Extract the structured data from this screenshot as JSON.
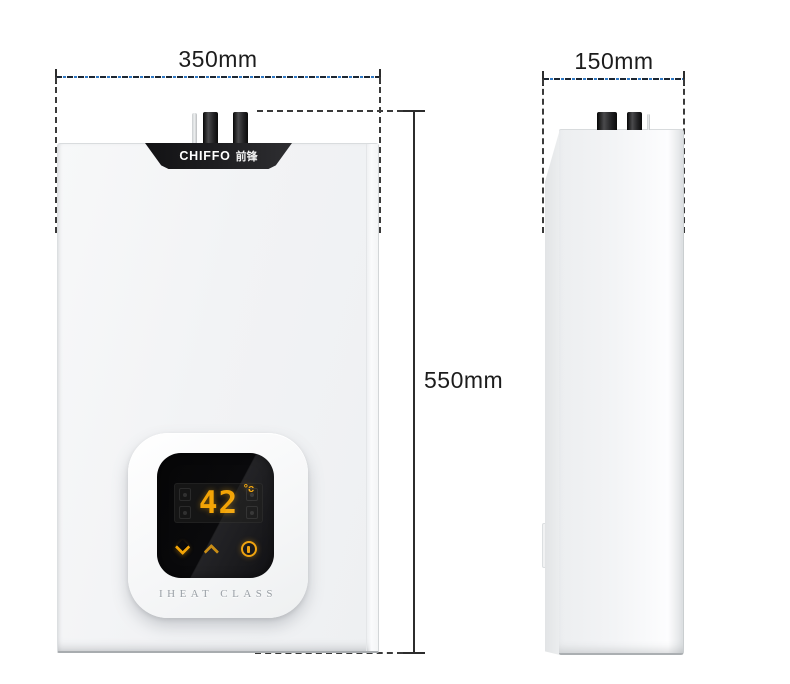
{
  "diagram": {
    "type": "product-dimensions",
    "views": [
      "front",
      "side"
    ]
  },
  "annotations": {
    "width": {
      "label": "350mm"
    },
    "depth": {
      "label": "150mm"
    },
    "height": {
      "label": "550mm"
    }
  },
  "front_view": {
    "brand": "CHIFFO",
    "brand_cn": "前锋",
    "display": {
      "temperature": "42",
      "unit": "°c"
    },
    "series_label": "IHEAT CLASS",
    "buttons": [
      "chevron-down",
      "chevron-up",
      "power"
    ]
  },
  "colors": {
    "display_accent": "#F3A406",
    "dimension_dash_blue": "#2F78C4",
    "dimension_dash_dark": "#1C2530",
    "cap_black": "#1D1D20",
    "body_gray": "#F2F3F5"
  },
  "icons": [
    "chevron-down-icon",
    "chevron-up-icon",
    "power-icon",
    "flue-pipe",
    "mode-ghost-icons"
  ]
}
